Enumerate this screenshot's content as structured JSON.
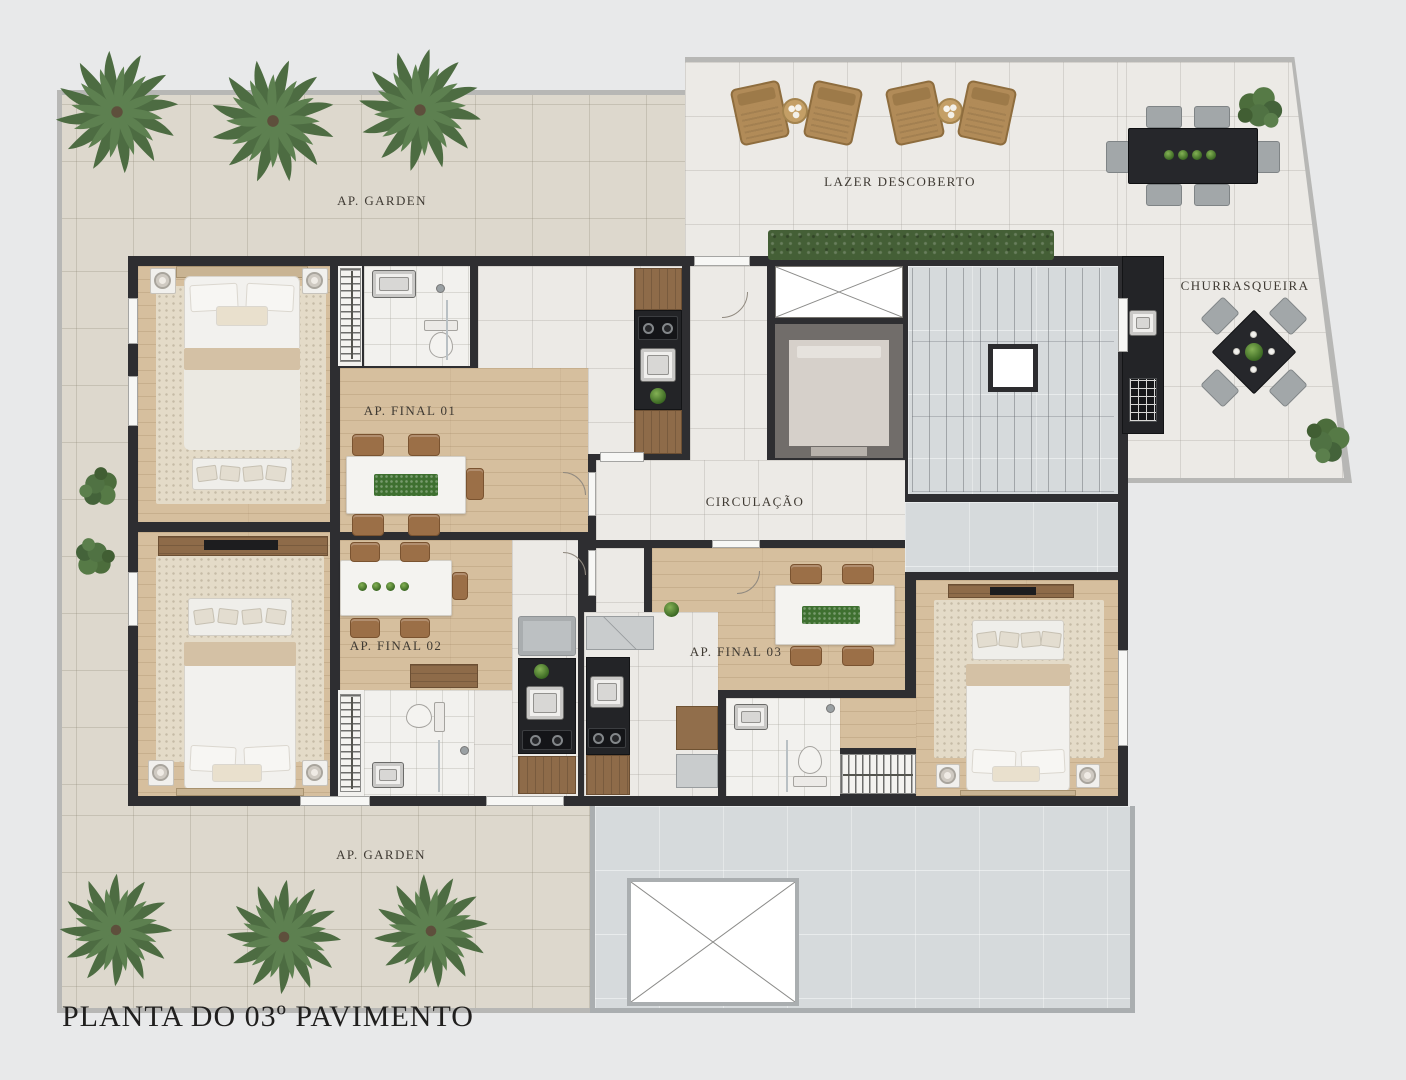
{
  "title": "PLANTA DO 03º PAVIMENTO",
  "areas": {
    "garden_top": "AP. GARDEN",
    "lazer": "LAZER DESCOBERTO",
    "churrasqueira": "CHURRASQUEIRA",
    "circulacao": "CIRCULAÇÃO",
    "ap01": "AP. FINAL 01",
    "ap02": "AP. FINAL 02",
    "ap03": "AP. FINAL 03",
    "garden_bottom": "AP. GARDEN"
  },
  "colors": {
    "wall": "#2e2e31",
    "wood_floor": "#d6bf9e",
    "tile_beige": "#ddd8cd",
    "tile_white": "#eceae6",
    "concrete": "#d6dadc",
    "counter_black": "#232427",
    "cabinet_wood": "#8e6b49",
    "hedge_green": "#445f36",
    "palm_green": "#4d6c42",
    "plant_green": "#3e7030",
    "lounger_tan": "#b18b58",
    "label_text": "#3f3a33"
  }
}
